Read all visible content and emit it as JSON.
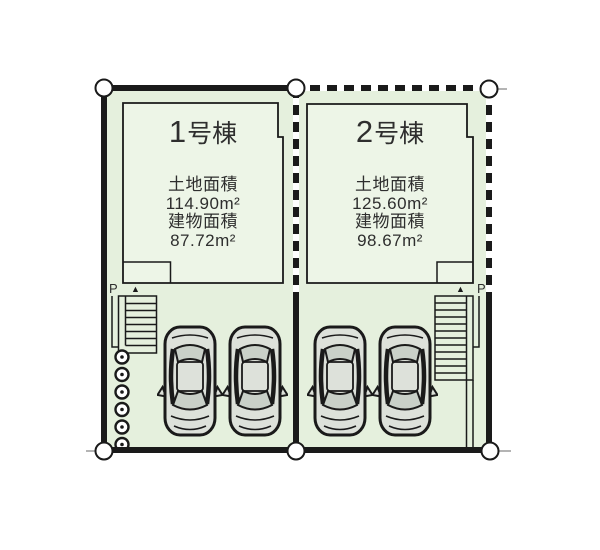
{
  "lots": [
    {
      "name_number": "1",
      "name_suffix": "号棟",
      "land_area_label": "土地面積",
      "land_area_value": "114.90m²",
      "building_area_label": "建物面積",
      "building_area_value": "87.72m²",
      "parking_label": "P",
      "entrance_marker": "▲"
    },
    {
      "name_number": "2",
      "name_suffix": "号棟",
      "land_area_label": "土地面積",
      "land_area_value": "125.60m²",
      "building_area_label": "建物面積",
      "building_area_value": "98.67m²",
      "parking_label": "P",
      "entrance_marker": "▲"
    }
  ],
  "colors": {
    "lot_fill": "#e5f0dd",
    "building_fill": "#edf5e7",
    "outline": "#1a1a1a",
    "car_body": "#dde1da",
    "car_window": "#c9d0c8",
    "boundary_marker_fill": "#ffffff"
  }
}
